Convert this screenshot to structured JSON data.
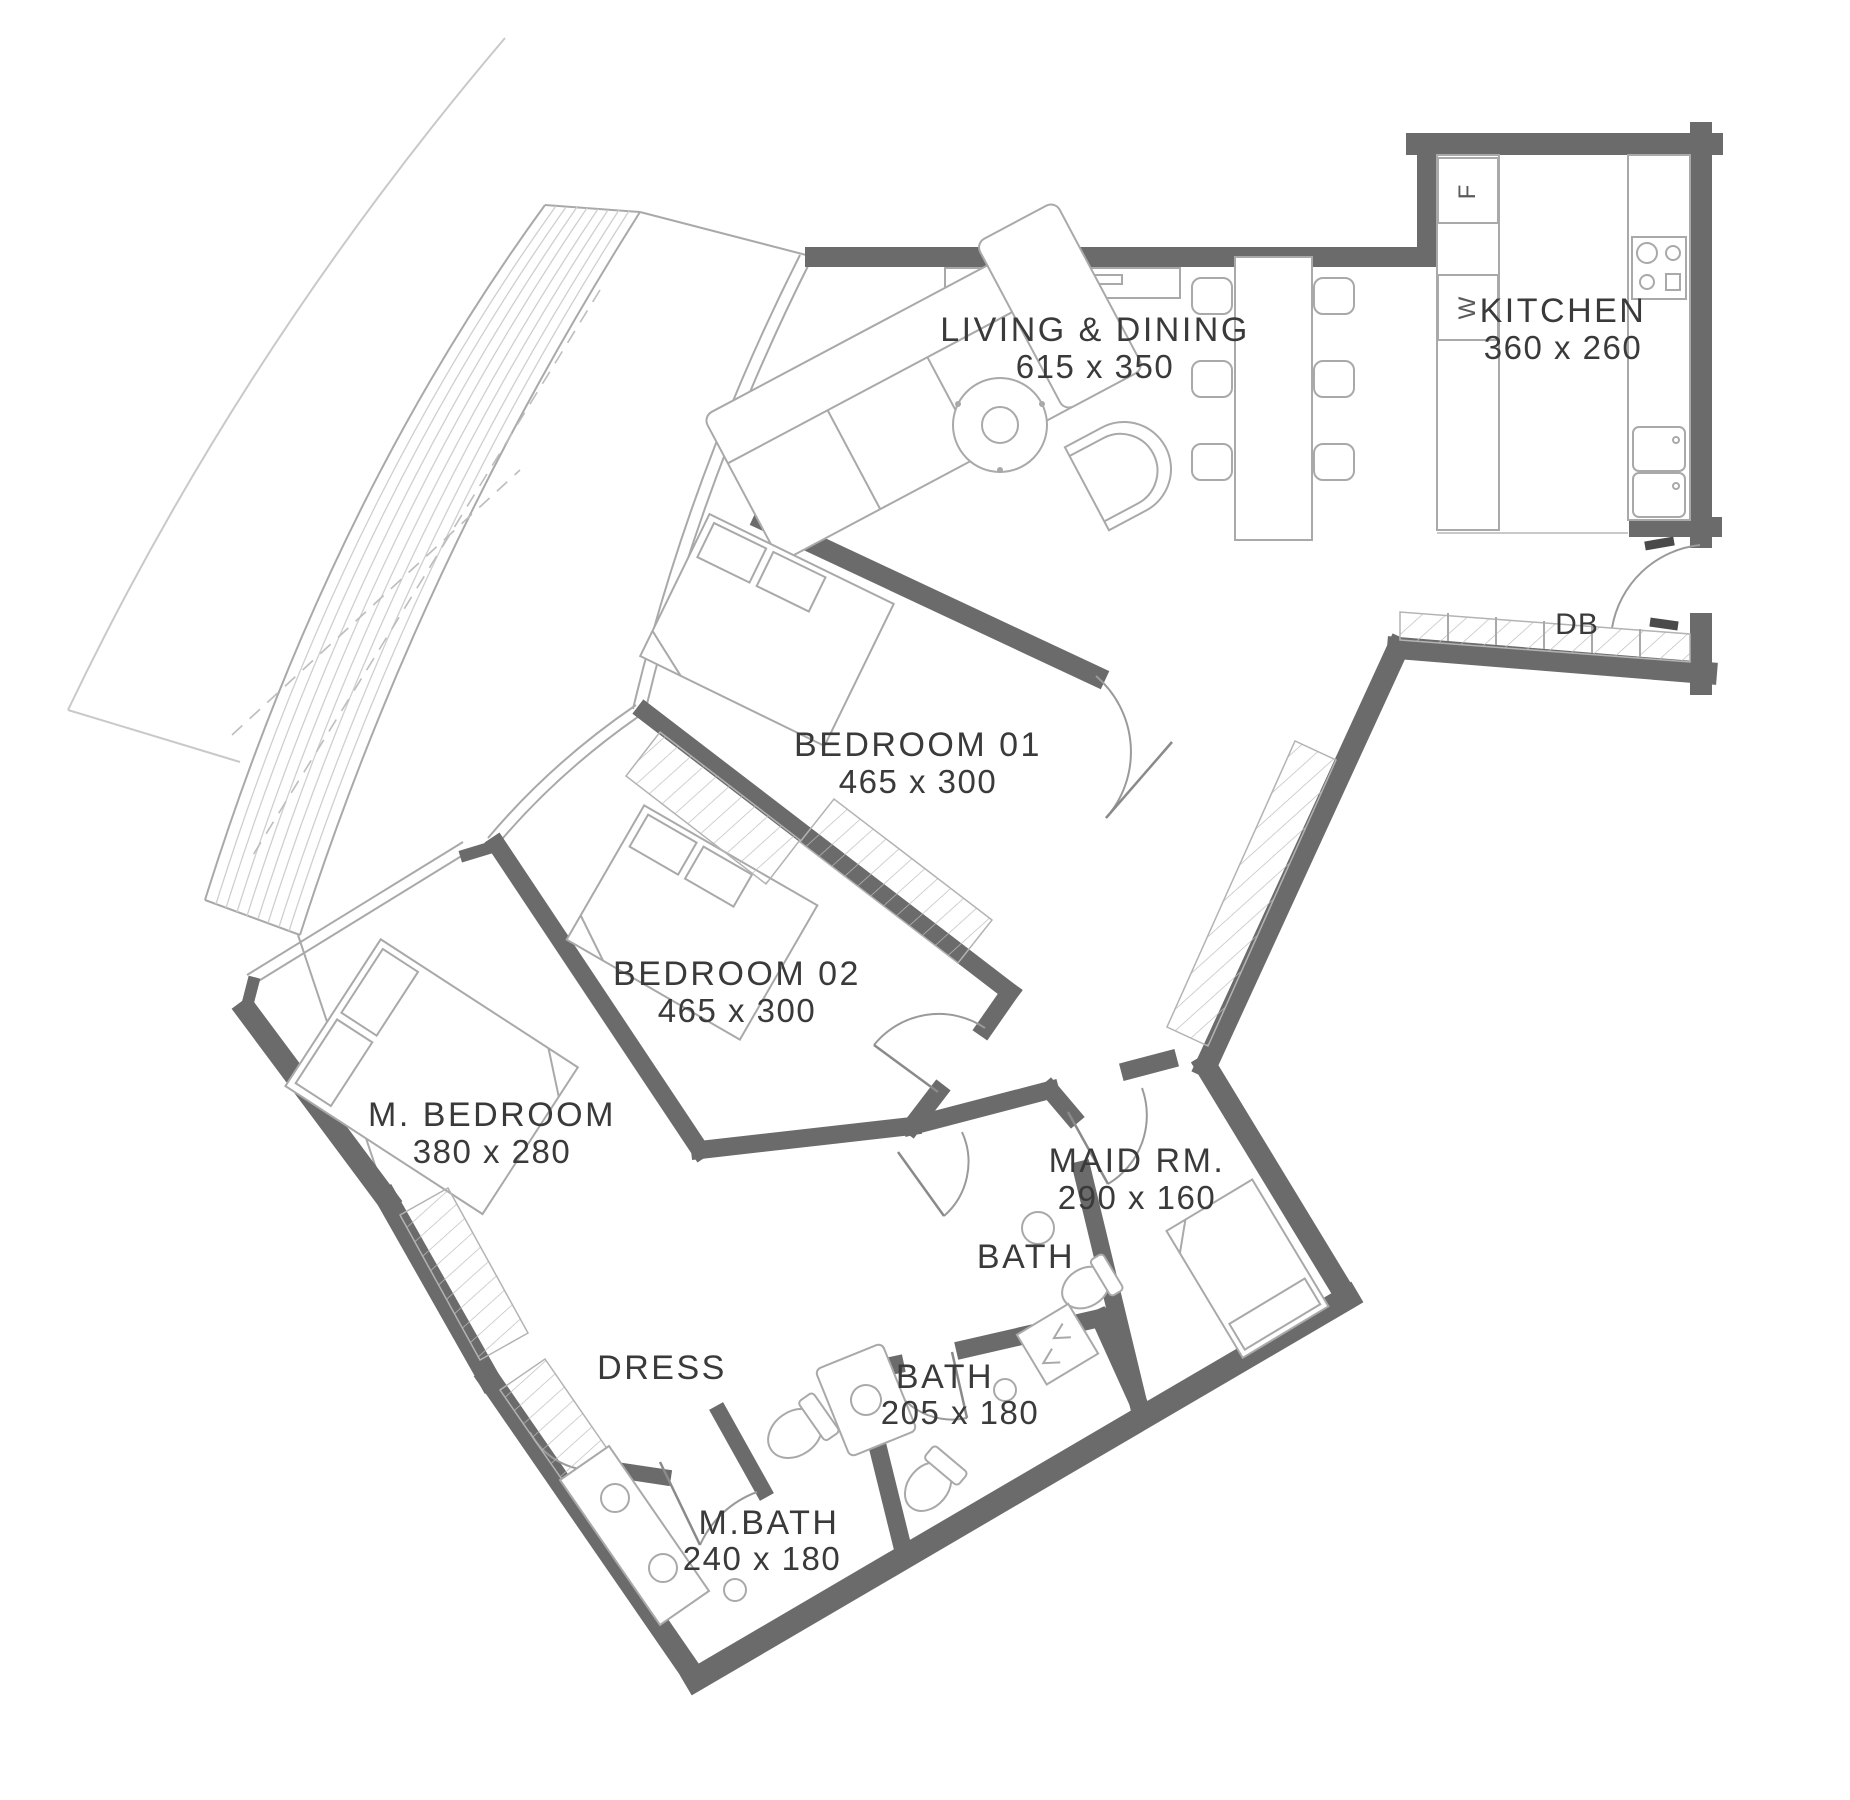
{
  "plan": {
    "type": "apartment-floor-plan",
    "rooms": {
      "living_dining": {
        "name": "LIVING & DINING",
        "dims": "615 x 350"
      },
      "kitchen": {
        "name": "KITCHEN",
        "dims": "360 x 260"
      },
      "bedroom_01": {
        "name": "BEDROOM 01",
        "dims": "465 x 300"
      },
      "bedroom_02": {
        "name": "BEDROOM 02",
        "dims": "465 x 300"
      },
      "master_bedroom": {
        "name": "M. BEDROOM",
        "dims": "380 x 280"
      },
      "maid_room": {
        "name": "MAID RM.",
        "dims": "290 x 160"
      },
      "maid_bath": {
        "name": "BATH"
      },
      "shared_bath": {
        "name": "BATH",
        "dims": "205 x 180"
      },
      "master_bath": {
        "name": "M.BATH",
        "dims": "240 x 180"
      },
      "dress": {
        "name": "DRESS"
      }
    },
    "annotations": {
      "distribution_board": "DB",
      "fridge": "F",
      "washer": "W"
    },
    "colors": {
      "wall": "#6b6b6b",
      "furniture_line": "#a9a9a9",
      "site_line": "#c9c9c9",
      "text": "#3a3a3a",
      "background": "#ffffff"
    }
  }
}
